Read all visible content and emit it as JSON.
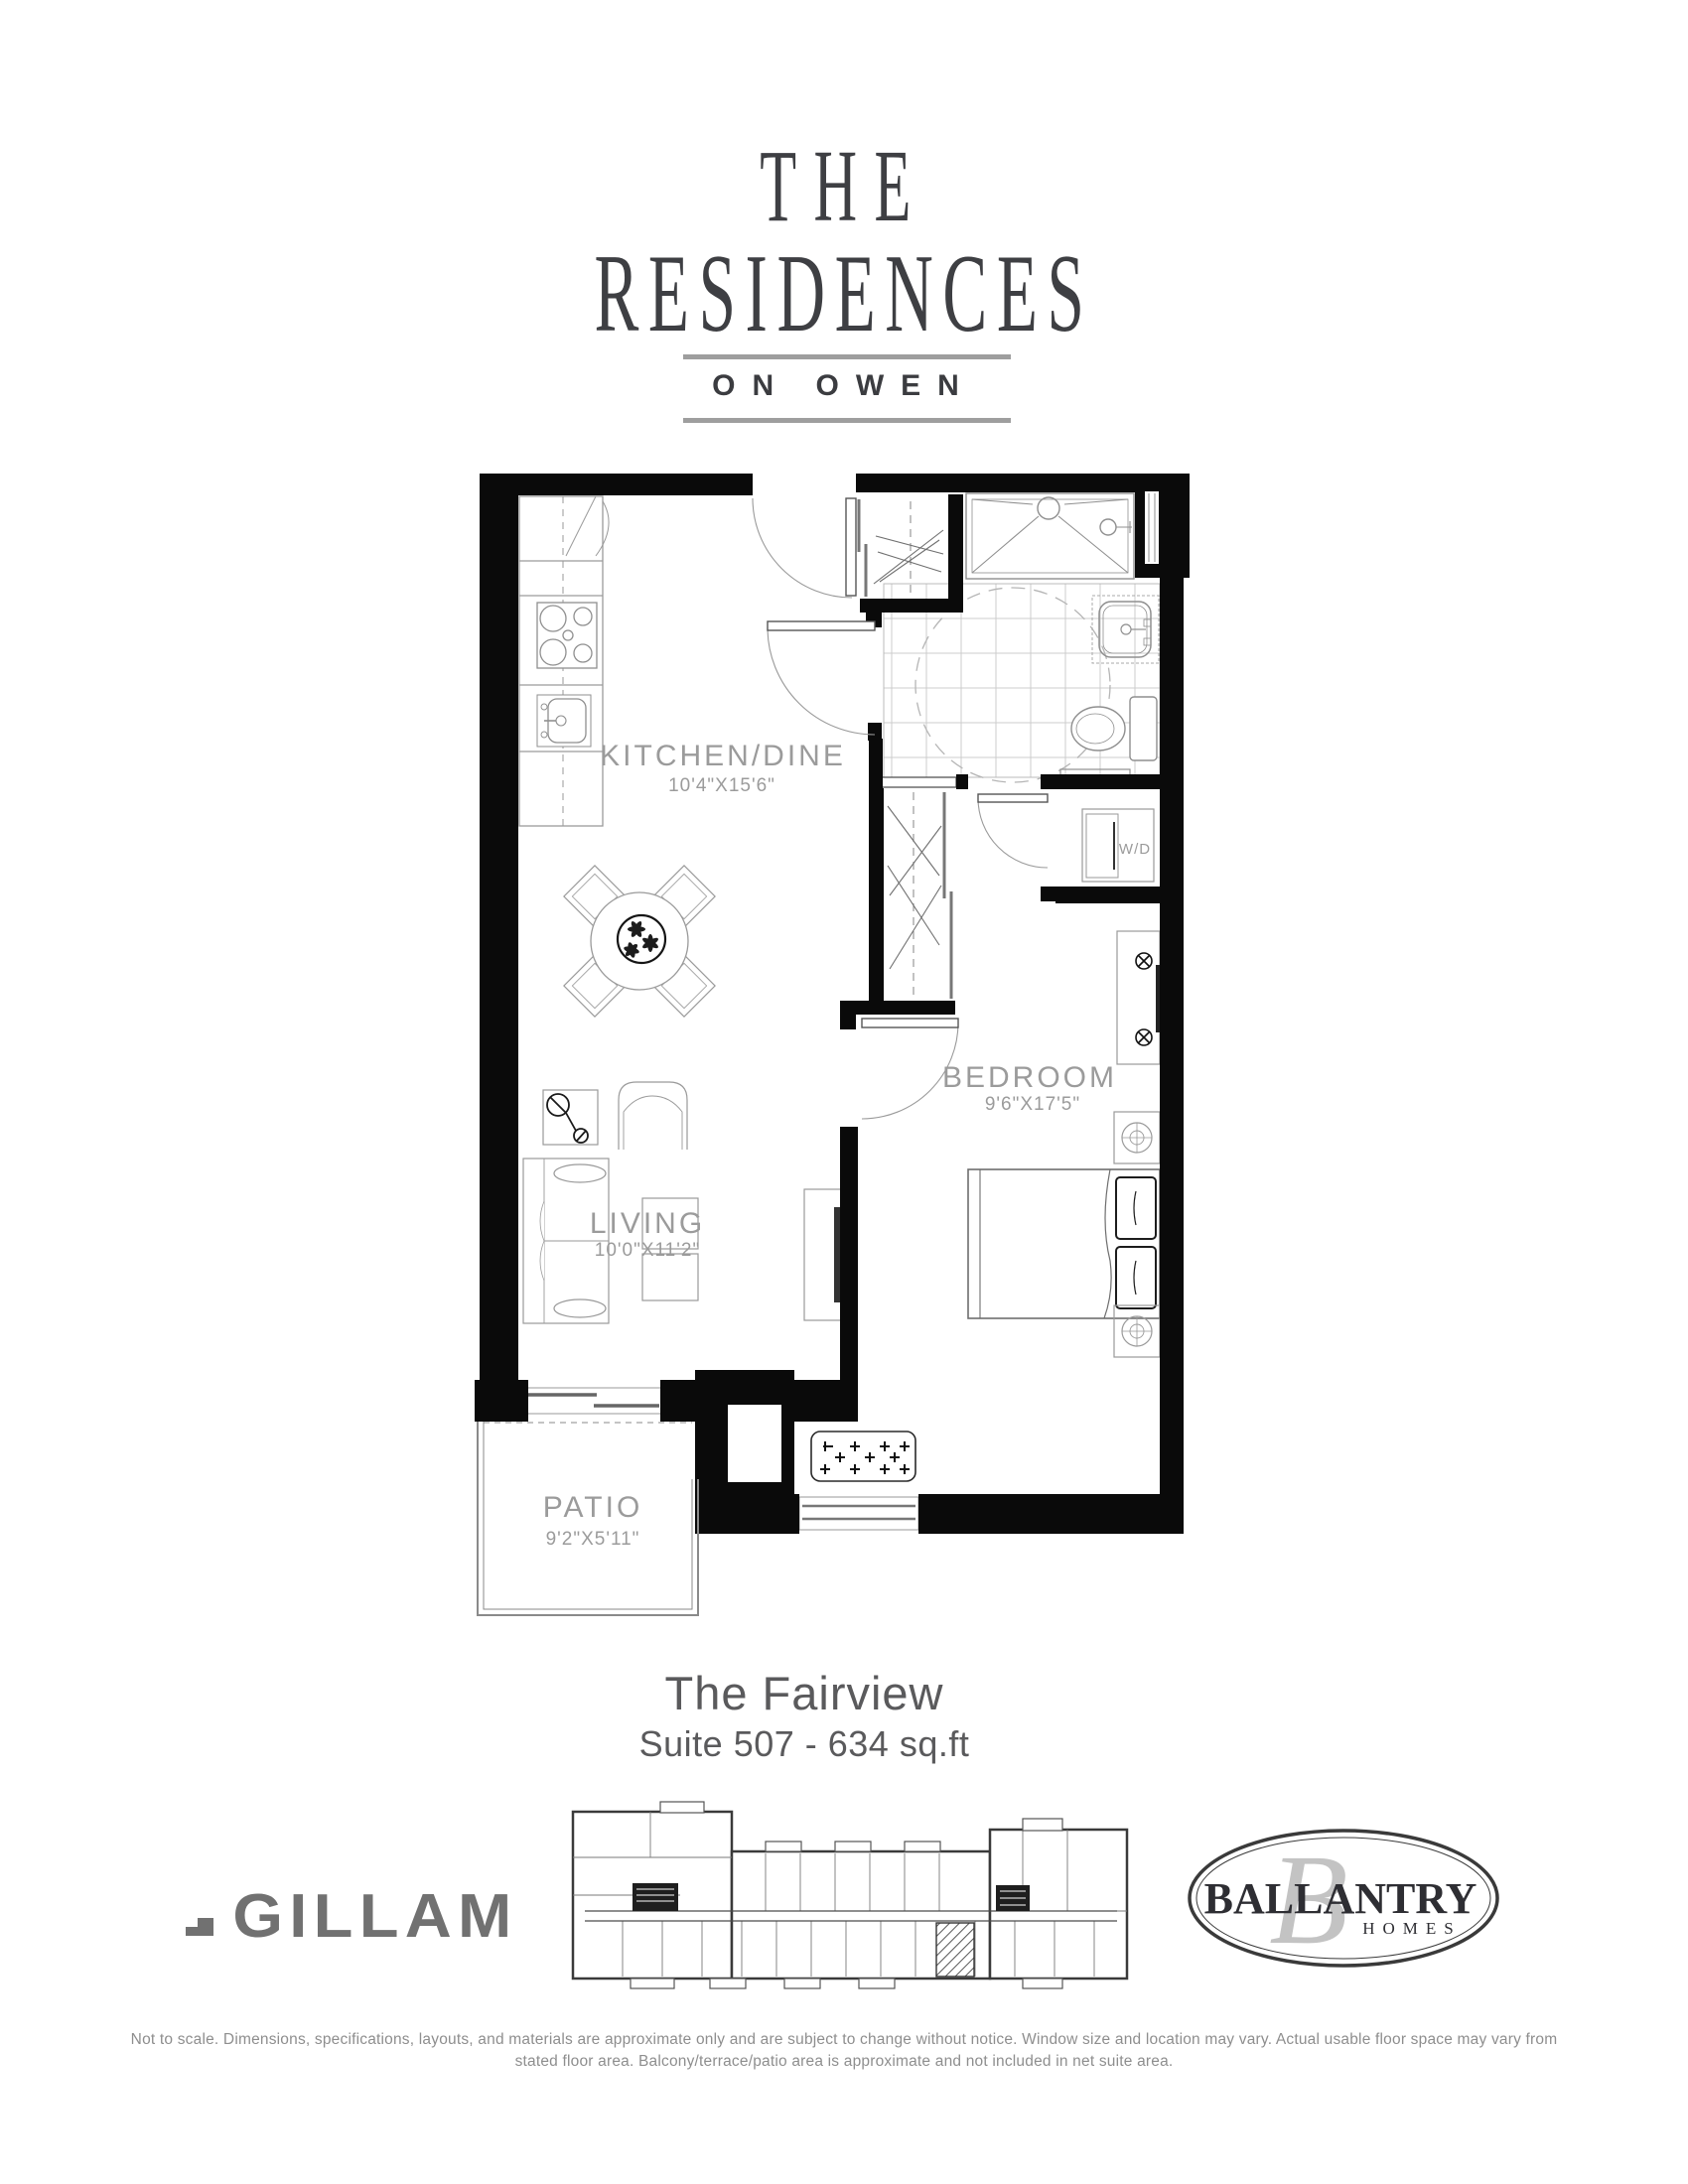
{
  "header": {
    "line1": "THE",
    "line2": "RESIDENCES",
    "tagline": "ON OWEN"
  },
  "plan": {
    "rooms": {
      "kitchen": {
        "name": "KITCHEN/DINE",
        "dims": "10'4\"X15'6\""
      },
      "living": {
        "name": "LIVING",
        "dims": "10'0\"X11'2\""
      },
      "bedroom": {
        "name": "BEDROOM",
        "dims": "9'6\"X17'5\""
      },
      "patio": {
        "name": "PATIO",
        "dims": "9'2\"X5'11\""
      },
      "laundry": {
        "name": "W/D"
      }
    }
  },
  "title": {
    "name": "The Fairview",
    "suite": "Suite 507 - 634 sq.ft"
  },
  "footer": {
    "builder_left": "GILLAM",
    "builder_right": {
      "name": "BALLANTRY",
      "sub": "HOMES",
      "monogram": "B"
    },
    "disclaimer_line1": "Not to scale. Dimensions, specifications, layouts, and materials are approximate only and are subject to change without notice. Window size and location may vary. Actual usable floor space may vary from",
    "disclaimer_line2": "stated floor area. Balcony/terrace/patio area is approximate and not included in net suite area."
  },
  "colors": {
    "wall": "#0a0a0a",
    "furniture": "#9a9a9a",
    "ink": "#1a1a1a",
    "tile": "#cccccc",
    "label": "#9b9b9b",
    "brand": "#3e3f43",
    "title": "#5a5a5c",
    "logo_gray": "#717171",
    "disclaimer": "#8e8e8e"
  }
}
